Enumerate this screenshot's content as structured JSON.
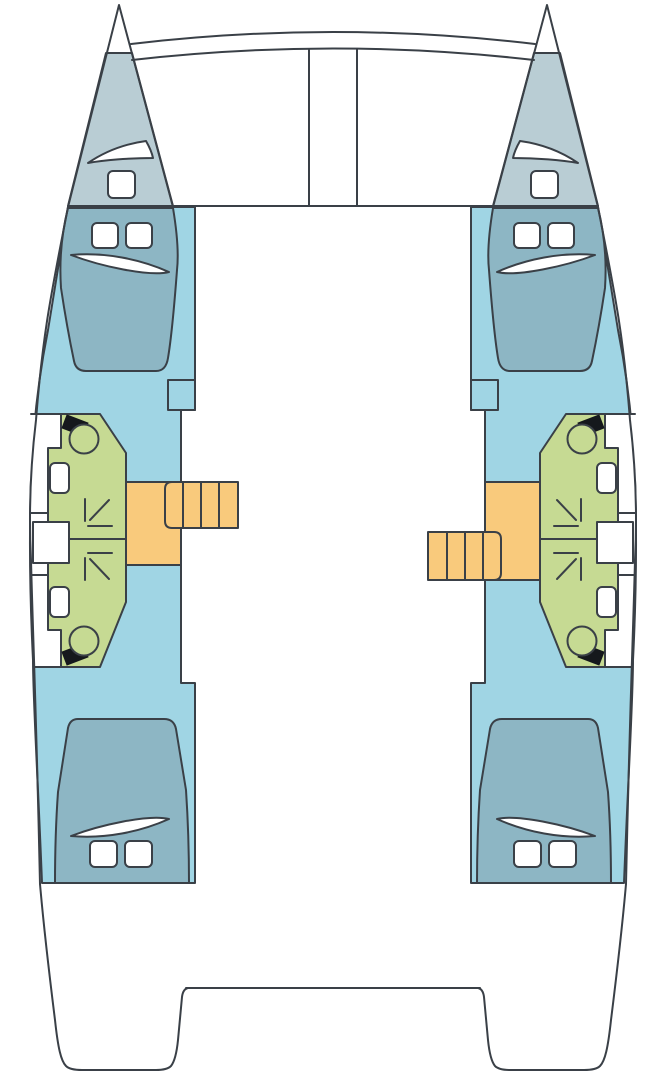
{
  "diagram": {
    "type": "catamaran-deck-plan",
    "view": "top-down interior layout, bow at top",
    "hulls": 2,
    "symmetry": "port and starboard hulls mirrored; companionway steps offset fore/aft",
    "areas": {
      "bow_trampoline": "netting area between bows with two curved crossbeams and center channel",
      "forepeaks": [
        "port forepeak locker with hatch",
        "starboard forepeak locker with hatch"
      ],
      "cabins": [
        {
          "name": "port forward cabin",
          "berth": "double berth",
          "hatches": 2,
          "pillow": true
        },
        {
          "name": "starboard forward cabin",
          "berth": "double berth",
          "hatches": 2,
          "pillow": true
        },
        {
          "name": "port aft cabin",
          "berth": "double berth",
          "hatches": 2,
          "pillow": true
        },
        {
          "name": "starboard aft cabin",
          "berth": "double berth",
          "hatches": 2,
          "pillow": true
        }
      ],
      "bathrooms": [
        {
          "name": "port forward head",
          "fixtures": [
            "toilet",
            "sink",
            "shower"
          ]
        },
        {
          "name": "port aft head",
          "fixtures": [
            "toilet",
            "sink",
            "shower"
          ]
        },
        {
          "name": "starboard forward head",
          "fixtures": [
            "toilet",
            "sink",
            "shower"
          ]
        },
        {
          "name": "starboard aft head",
          "fixtures": [
            "toilet",
            "sink",
            "shower"
          ]
        }
      ],
      "companionways": [
        {
          "name": "port companionway",
          "steps": 4,
          "landing": true
        },
        {
          "name": "starboard companionway",
          "steps": 4,
          "landing": true
        }
      ],
      "stern": "twin transoms with aft crossbeam cutout"
    },
    "windows": "one hull window outboard of each head compartment"
  },
  "colors": {
    "bg": "#ffffff",
    "line": "#3a4047",
    "deck": "#b9cdd4",
    "cabin": "#a0d5e4",
    "berth": "#8db6c4",
    "bath": "#c6da93",
    "stairs": "#f9ca7c",
    "white": "#ffffff",
    "black": "#15181c"
  }
}
